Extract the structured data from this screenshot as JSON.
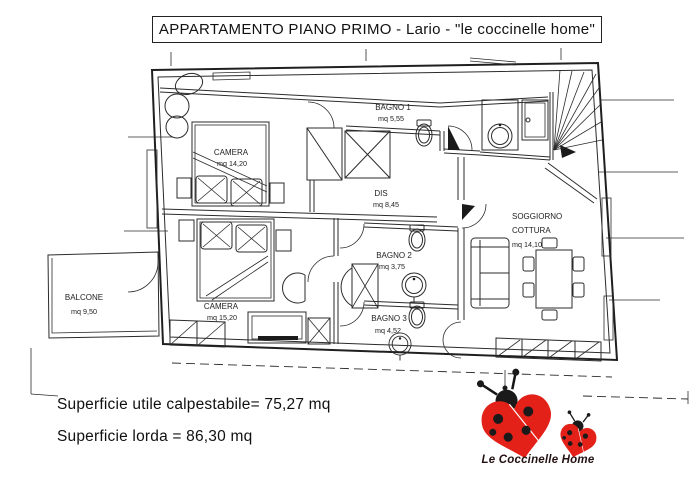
{
  "title": "APPARTAMENTO PIANO PRIMO - Lario - \"le coccinelle home\"",
  "plan": {
    "rooms": [
      {
        "name": "CAMERA",
        "area": "mq 14,20"
      },
      {
        "name": "BAGNO 1",
        "area": "mq 5,55"
      },
      {
        "name": "DIS",
        "area": "mq 8,45"
      },
      {
        "name": "SOGGIORNO",
        "name2": "COTTURA",
        "area": "mq 14,10"
      },
      {
        "name": "BAGNO 2",
        "area": "mq 3,75"
      },
      {
        "name": "BAGNO 3",
        "area": "mq 4,52"
      },
      {
        "name": "CAMERA",
        "area": "mq 15,20"
      },
      {
        "name": "BALCONE",
        "area": "mq 9,50"
      }
    ]
  },
  "summary": {
    "line1": "Superficie utile calpestabile= 75,27 mq",
    "line2": "Superficie lorda = 86,30 mq"
  },
  "logo": {
    "text": "Le Coccinelle Home",
    "red": "#e32119",
    "black": "#161616"
  }
}
